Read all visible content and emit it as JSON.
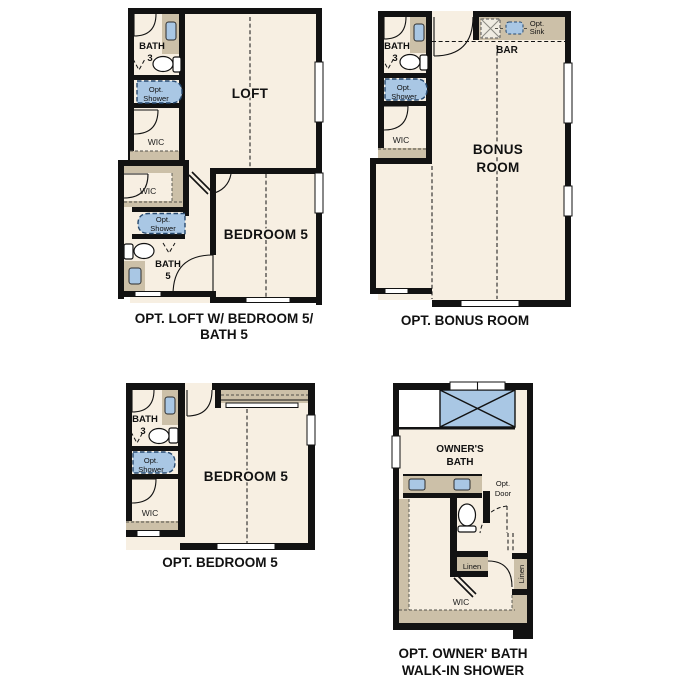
{
  "colors": {
    "floor": "#f7efe2",
    "wall": "#121212",
    "cabinet_tan": "#ccc0a8",
    "fixture_blue": "#a9c7e4",
    "fixture_blue_line": "#27496e",
    "hatch_fill": "#efece2",
    "text": "#111111"
  },
  "plans": {
    "loft": {
      "caption1": "OPT. LOFT W/ BEDROOM 5/",
      "caption2": "BATH 5",
      "loft_label": "LOFT",
      "bedroom_label": "BEDROOM 5",
      "bath3_l1": "BATH",
      "bath3_l2": "3",
      "bath5_l1": "BATH",
      "bath5_l2": "5",
      "shower1_l1": "Opt.",
      "shower1_l2": "Shower",
      "shower2_l1": "Opt.",
      "shower2_l2": "Shower",
      "wic1": "WIC",
      "wic2": "WIC"
    },
    "bonus": {
      "caption": "OPT. BONUS ROOM",
      "room_l1": "BONUS",
      "room_l2": "ROOM",
      "bar": "BAR",
      "sink_l1": "Opt.",
      "sink_l2": "Sink",
      "bath3_l1": "BATH",
      "bath3_l2": "3",
      "shower_l1": "Opt.",
      "shower_l2": "Shower",
      "wic": "WIC"
    },
    "bedroom5": {
      "caption": "OPT. BEDROOM 5",
      "bedroom_label": "BEDROOM 5",
      "bath3_l1": "BATH",
      "bath3_l2": "3",
      "shower_l1": "Opt.",
      "shower_l2": "Shower",
      "wic": "WIC"
    },
    "owner": {
      "caption1": "OPT. OWNER' BATH",
      "caption2": "WALK-IN SHOWER",
      "bath_l1": "OWNER'S",
      "bath_l2": "BATH",
      "door_l1": "Opt.",
      "door_l2": "Door",
      "linen1": "Linen",
      "linen2": "Linen",
      "wic": "WIC"
    }
  }
}
